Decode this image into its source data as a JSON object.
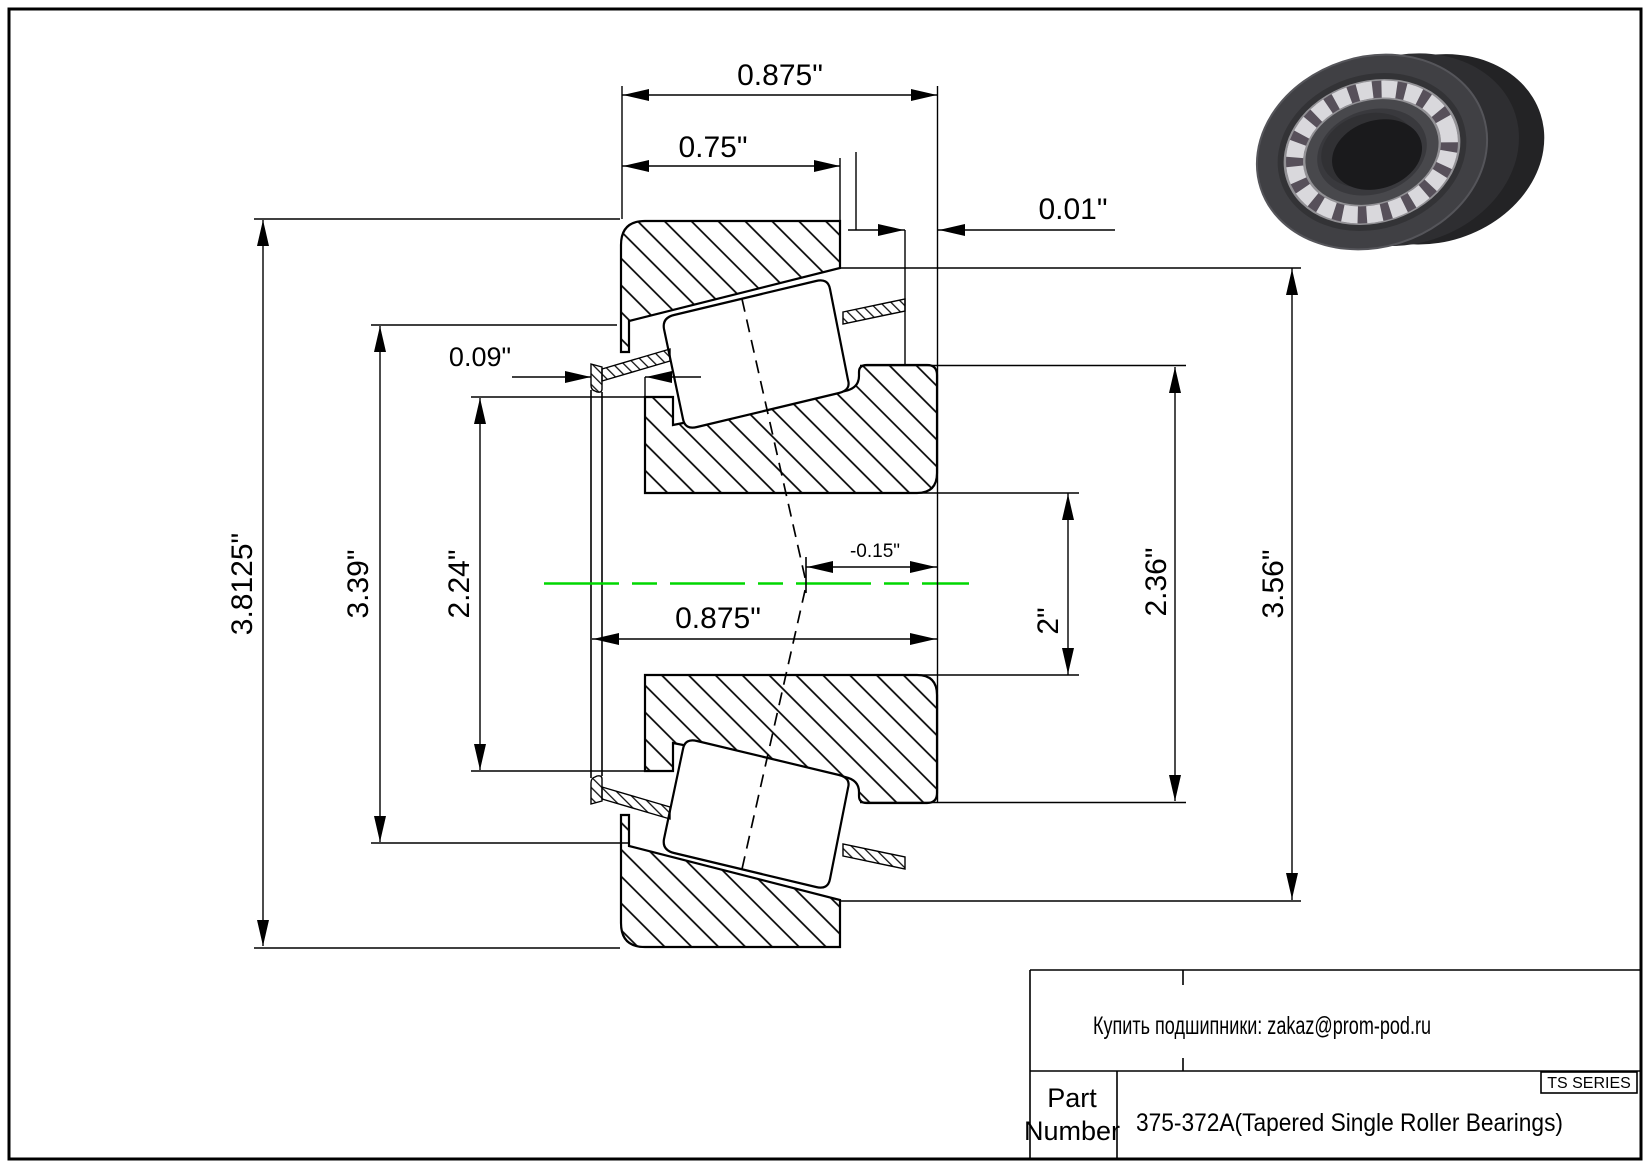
{
  "drawing": {
    "dims": {
      "overall_width": "0.875\"",
      "cup_width": "0.75\"",
      "back_gap": "0.01\"",
      "front_protrusion": "0.09\"",
      "cone_width": "0.875\"",
      "center_offset": "-0.15\"",
      "flange_diameter": "3.8125\"",
      "cage_diameter": "3.39\"",
      "front_rib_diameter": "2.24\"",
      "bore_diameter": "2\"",
      "back_rib_diameter": "2.36\"",
      "cup_outer_diameter": "3.56\""
    }
  },
  "title_block": {
    "contact": "Купить подшипники: zakaz@prom-pod.ru",
    "series": "TS SERIES",
    "part_label_line1": "Part",
    "part_label_line2": "Number",
    "part_number": "375-372A(Tapered Single Roller Bearings)"
  },
  "colors": {
    "centerline": "#00d700"
  }
}
